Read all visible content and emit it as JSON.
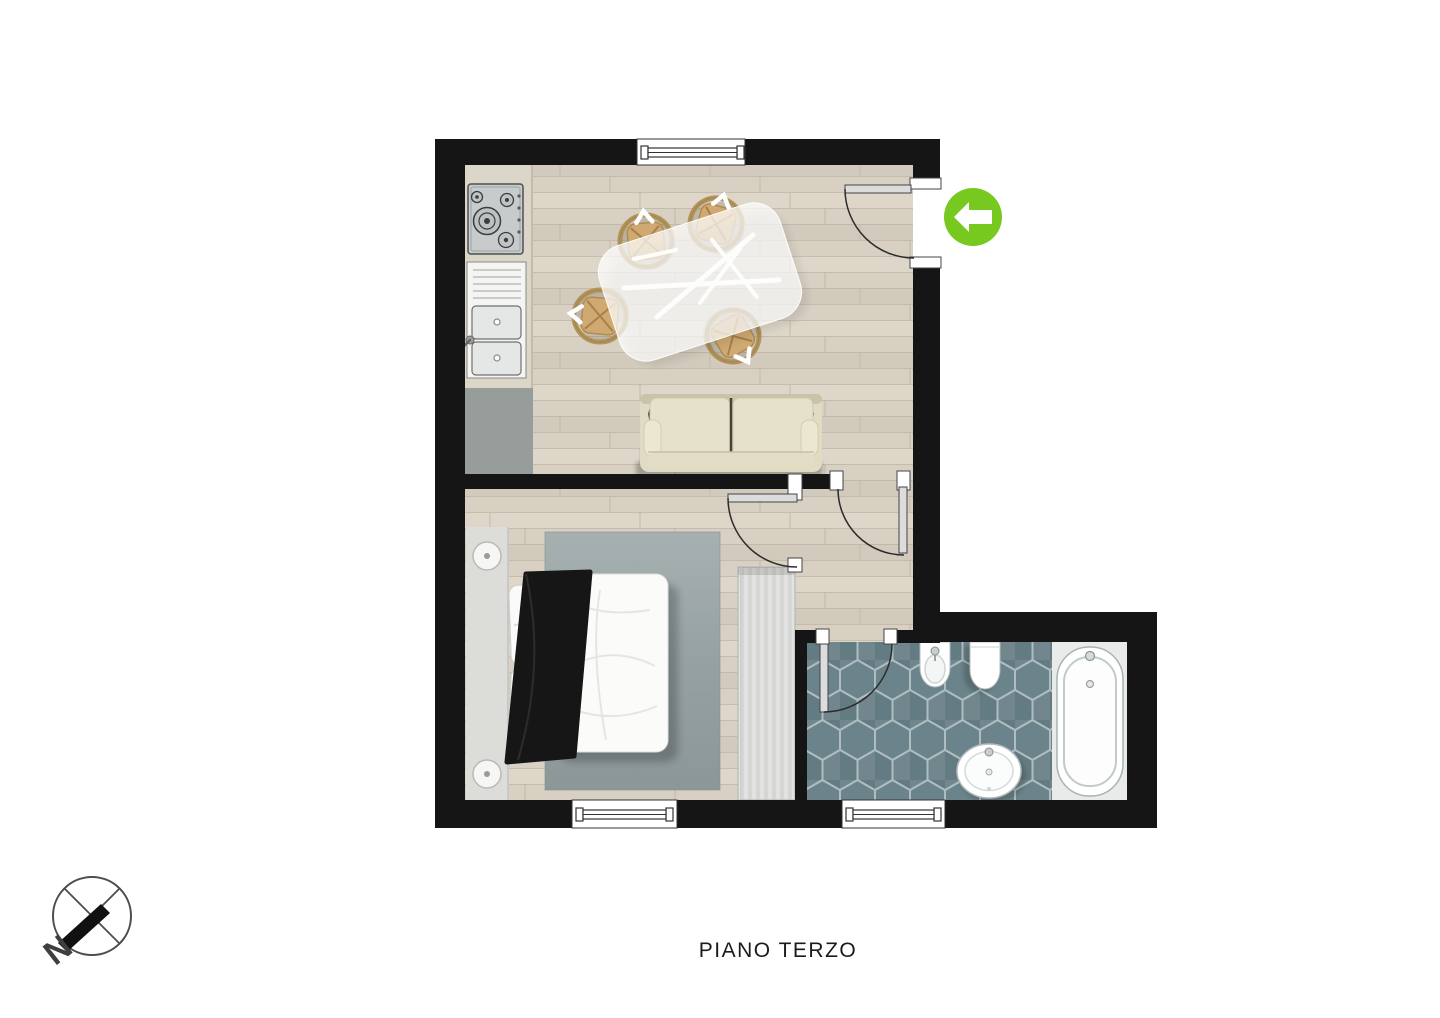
{
  "page": {
    "background": "#ffffff",
    "floor_label": "PIANO TERZO"
  },
  "compass": {
    "letter": "N",
    "needle_points": "southwest"
  },
  "entrance": {
    "marker_color": "#77c81f",
    "icon": "arrow-left",
    "location": "outside entry door, top right of plan"
  },
  "palette": {
    "wall": "#151515",
    "wood_floor": "#d7d0c3",
    "bath_tile": "#6b838a",
    "tile_grout": "#aebec0",
    "rug": "#98a3a4",
    "sofa": "#e3dec6",
    "chair_rattan": "#cfa971",
    "counter_grey": "#9ba19e",
    "fixture_white": "#ffffff",
    "blanket_black": "#161616"
  },
  "rooms": [
    {
      "id": "living-kitchen",
      "floor": "wood-planks",
      "features": [
        "kitchen-counter",
        "gas-hob",
        "double-sink",
        "dining-table",
        "four-rattan-chairs",
        "sofa"
      ]
    },
    {
      "id": "bedroom",
      "floor": "wood-planks",
      "features": [
        "headboard-panel",
        "two-bedside-lamps",
        "double-bed",
        "two-pillows",
        "black-throw",
        "rug",
        "wardrobe"
      ]
    },
    {
      "id": "hallway",
      "floor": "wood-planks",
      "features": []
    },
    {
      "id": "bathroom",
      "floor": "hexagonal-tiles",
      "features": [
        "bathtub",
        "washbasin",
        "toilet",
        "bidet"
      ]
    }
  ],
  "openings": {
    "windows": [
      "top-wall-living",
      "bottom-wall-bedroom",
      "bottom-wall-bathroom"
    ],
    "doors": [
      "entry-door",
      "living-to-hallway-door",
      "bedroom-door",
      "bathroom-door"
    ]
  }
}
